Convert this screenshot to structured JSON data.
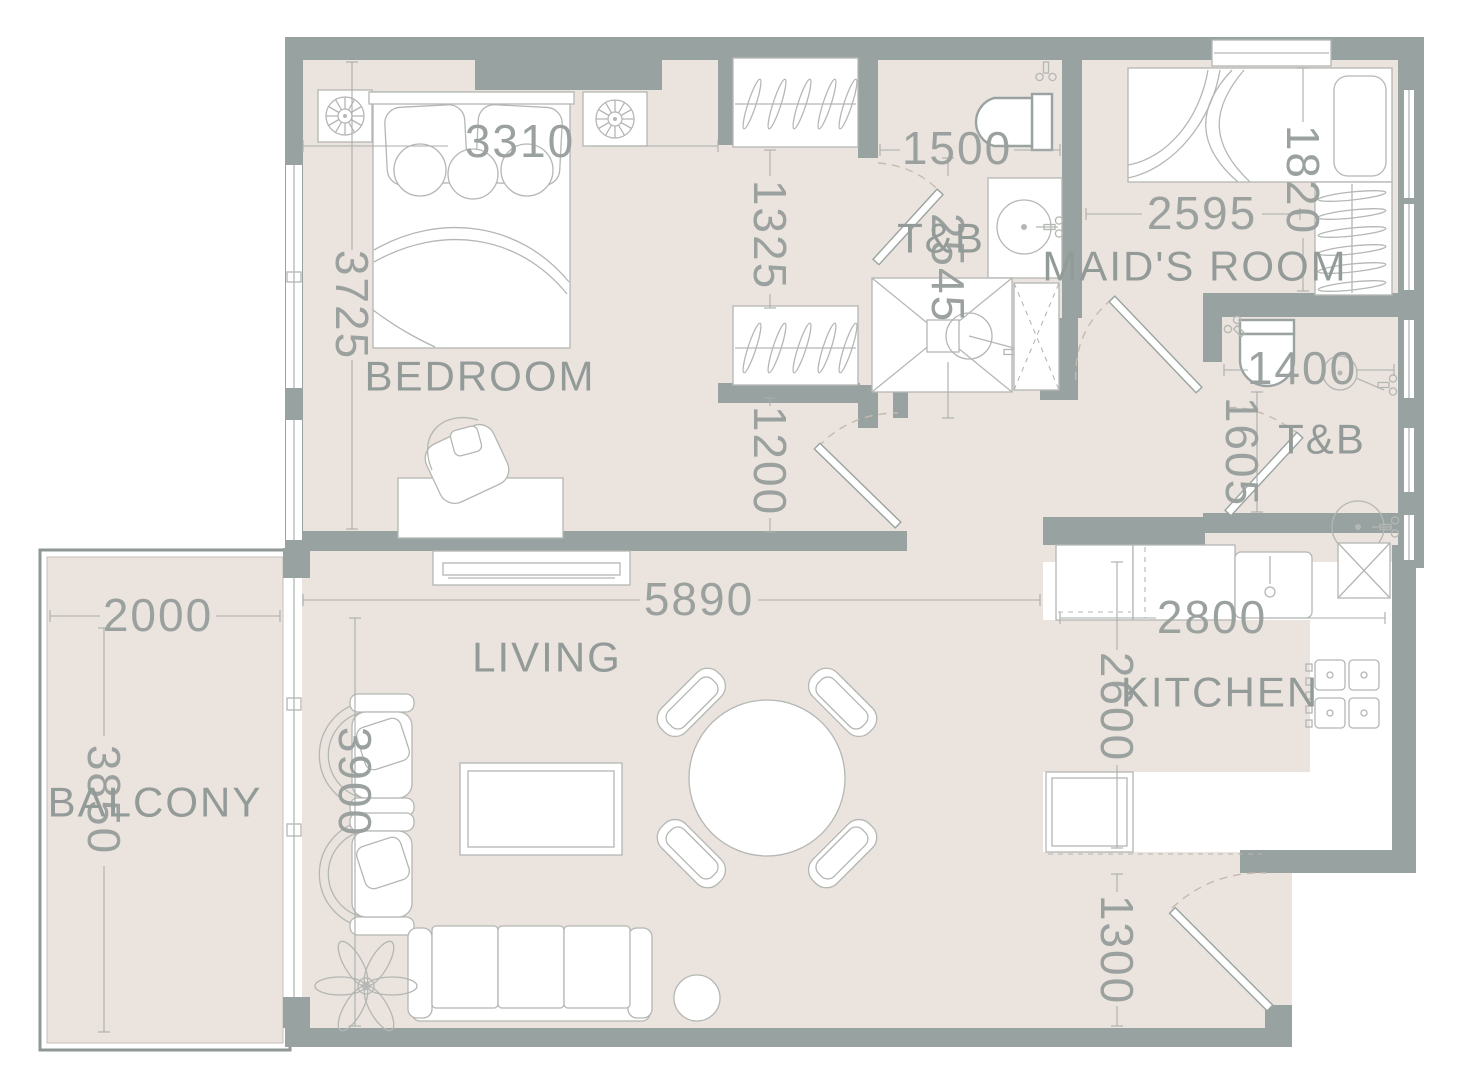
{
  "plan_type": "apartment-floor-plan",
  "colors": {
    "wall": "#98a2a0",
    "floor": "#ebe3dd",
    "dimension_text": "#9aa19e",
    "furniture_outline": "#b4b7b4",
    "door_swing": "#c6bab0"
  },
  "rooms": {
    "bedroom": {
      "label": "BEDROOM",
      "width": "3310",
      "depth": "3725"
    },
    "closet": {
      "upper": "1325",
      "lower": "1200"
    },
    "bath_main": {
      "label": "T&B",
      "width": "1500",
      "depth": "2545"
    },
    "maids_room": {
      "label": "MAID'S ROOM",
      "width": "2595",
      "depth": "1820"
    },
    "bath_maids": {
      "label": "T&B",
      "width": "1400",
      "depth": "1605"
    },
    "living": {
      "label": "LIVING",
      "width": "5890",
      "depth": "3900"
    },
    "kitchen": {
      "label": "KITCHEN",
      "width": "2800",
      "depth": "2600"
    },
    "entry": {
      "depth": "1300"
    },
    "balcony": {
      "label": "BALCONY",
      "width": "2000",
      "depth": "3850"
    }
  }
}
